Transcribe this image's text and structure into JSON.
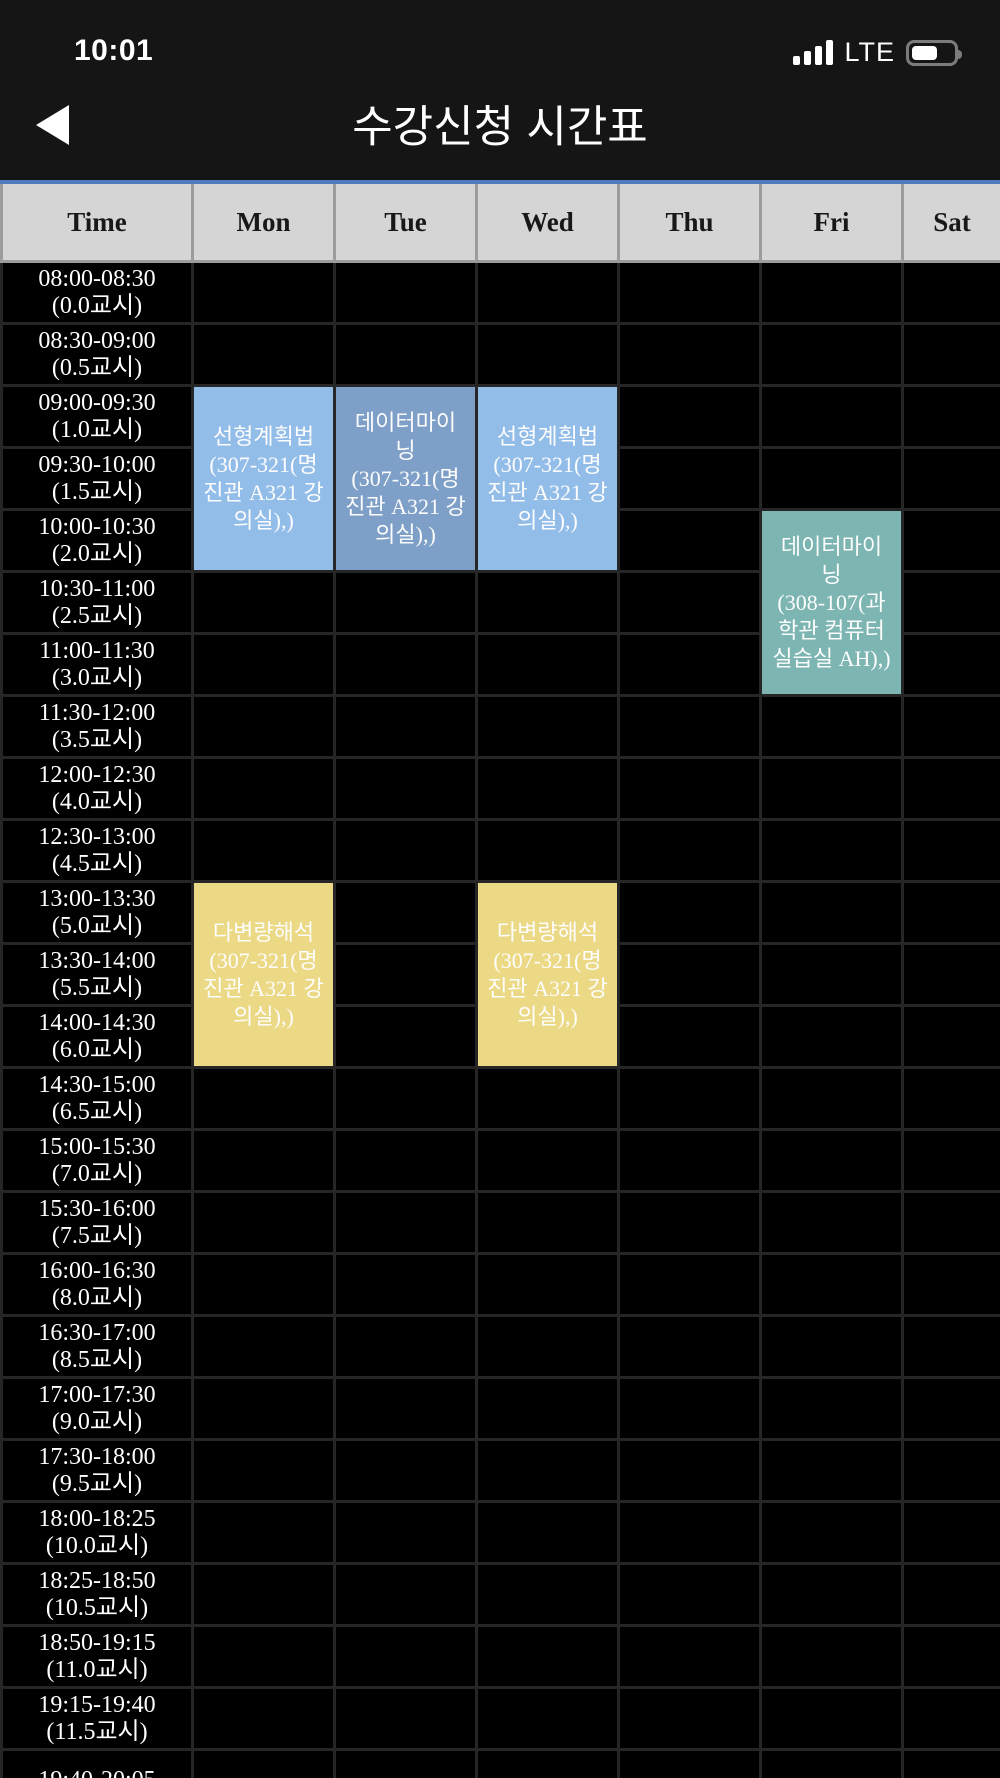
{
  "status_bar": {
    "time": "10:01",
    "network": "LTE",
    "signal_icon": "cellular-signal-4-bars",
    "battery_icon": "battery-half"
  },
  "nav": {
    "title": "수강신청 시간표",
    "back_icon": "back-arrow"
  },
  "timetable": {
    "columns": [
      "Time",
      "Mon",
      "Tue",
      "Wed",
      "Thu",
      "Fri",
      "Sat"
    ],
    "colors": {
      "accent_top_border": "#4d7bbd",
      "header_background": "#d5d5d5",
      "grid_line": "#262626"
    },
    "time_rows": [
      {
        "range": "08:00-08:30",
        "period": "(0.0교시)"
      },
      {
        "range": "08:30-09:00",
        "period": "(0.5교시)"
      },
      {
        "range": "09:00-09:30",
        "period": "(1.0교시)"
      },
      {
        "range": "09:30-10:00",
        "period": "(1.5교시)"
      },
      {
        "range": "10:00-10:30",
        "period": "(2.0교시)"
      },
      {
        "range": "10:30-11:00",
        "period": "(2.5교시)"
      },
      {
        "range": "11:00-11:30",
        "period": "(3.0교시)"
      },
      {
        "range": "11:30-12:00",
        "period": "(3.5교시)"
      },
      {
        "range": "12:00-12:30",
        "period": "(4.0교시)"
      },
      {
        "range": "12:30-13:00",
        "period": "(4.5교시)"
      },
      {
        "range": "13:00-13:30",
        "period": "(5.0교시)"
      },
      {
        "range": "13:30-14:00",
        "period": "(5.5교시)"
      },
      {
        "range": "14:00-14:30",
        "period": "(6.0교시)"
      },
      {
        "range": "14:30-15:00",
        "period": "(6.5교시)"
      },
      {
        "range": "15:00-15:30",
        "period": "(7.0교시)"
      },
      {
        "range": "15:30-16:00",
        "period": "(7.5교시)"
      },
      {
        "range": "16:00-16:30",
        "period": "(8.0교시)"
      },
      {
        "range": "16:30-17:00",
        "period": "(8.5교시)"
      },
      {
        "range": "17:00-17:30",
        "period": "(9.0교시)"
      },
      {
        "range": "17:30-18:00",
        "period": "(9.5교시)"
      },
      {
        "range": "18:00-18:25",
        "period": "(10.0교시)"
      },
      {
        "range": "18:25-18:50",
        "period": "(10.5교시)"
      },
      {
        "range": "18:50-19:15",
        "period": "(11.0교시)"
      },
      {
        "range": "19:15-19:40",
        "period": "(11.5교시)"
      },
      {
        "range": "19:40-20:05",
        "period": ""
      }
    ],
    "courses": [
      {
        "day": "Mon",
        "start_row": 2,
        "rowspan": 3,
        "title": "선형계획법",
        "location": "(307-321(명진관 A321 강의실),)",
        "color": "#93bde9"
      },
      {
        "day": "Tue",
        "start_row": 2,
        "rowspan": 3,
        "title": "데이터마이닝",
        "location": "(307-321(명진관 A321 강의실),)",
        "color": "#7e9fc7"
      },
      {
        "day": "Wed",
        "start_row": 2,
        "rowspan": 3,
        "title": "선형계획법",
        "location": "(307-321(명진관 A321 강의실),)",
        "color": "#93bde9"
      },
      {
        "day": "Fri",
        "start_row": 4,
        "rowspan": 3,
        "title": "데이터마이닝",
        "location": "(308-107(과학관 컴퓨터실습실 AH),)",
        "color": "#7cb5b2"
      },
      {
        "day": "Mon",
        "start_row": 10,
        "rowspan": 3,
        "title": "다변량해석",
        "location": "(307-321(명진관 A321 강의실),)",
        "color": "#ecd985"
      },
      {
        "day": "Wed",
        "start_row": 10,
        "rowspan": 3,
        "title": "다변량해석",
        "location": "(307-321(명진관 A321 강의실),)",
        "color": "#ecd985"
      }
    ]
  }
}
